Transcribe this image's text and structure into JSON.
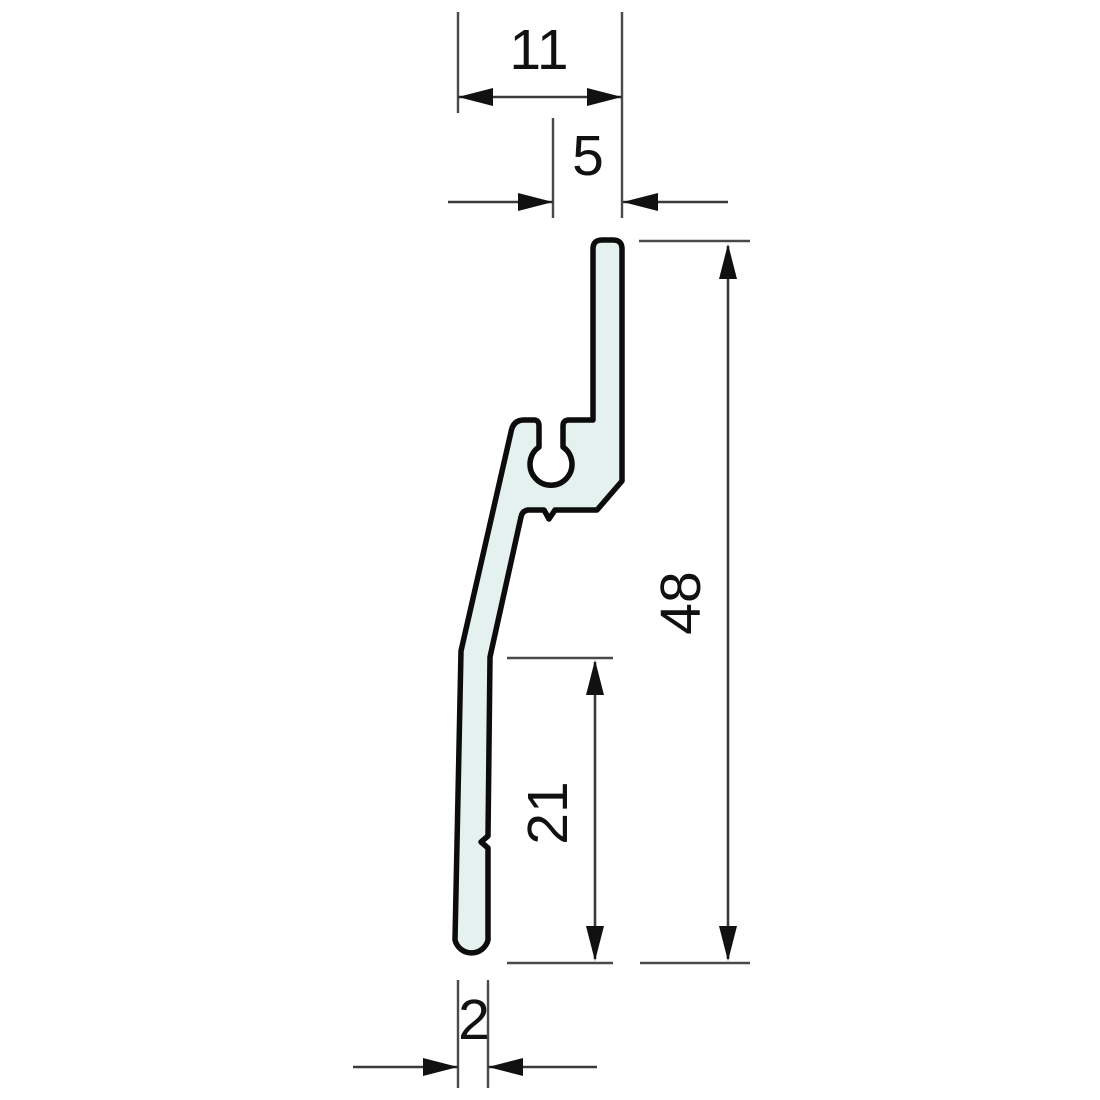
{
  "drawing": {
    "description": "Technical cross-section drawing of an extruded profile with keyhole screw channel",
    "unit": "mm",
    "colors": {
      "background": "#ffffff",
      "profile_fill": "#e4f1ef",
      "profile_outline": "#0c0c0c",
      "dimension_line": "#3a3a3a",
      "text": "#111111"
    },
    "dimensions": [
      {
        "id": "top-width",
        "label": "11",
        "value": 11,
        "orientation": "horizontal"
      },
      {
        "id": "screw-channel-offset",
        "label": "5",
        "value": 5,
        "orientation": "horizontal"
      },
      {
        "id": "total-height",
        "label": "48",
        "value": 48,
        "orientation": "vertical"
      },
      {
        "id": "lower-leg-height",
        "label": "21",
        "value": 21,
        "orientation": "vertical"
      },
      {
        "id": "leg-thickness",
        "label": "2",
        "value": 2,
        "orientation": "horizontal"
      }
    ]
  }
}
